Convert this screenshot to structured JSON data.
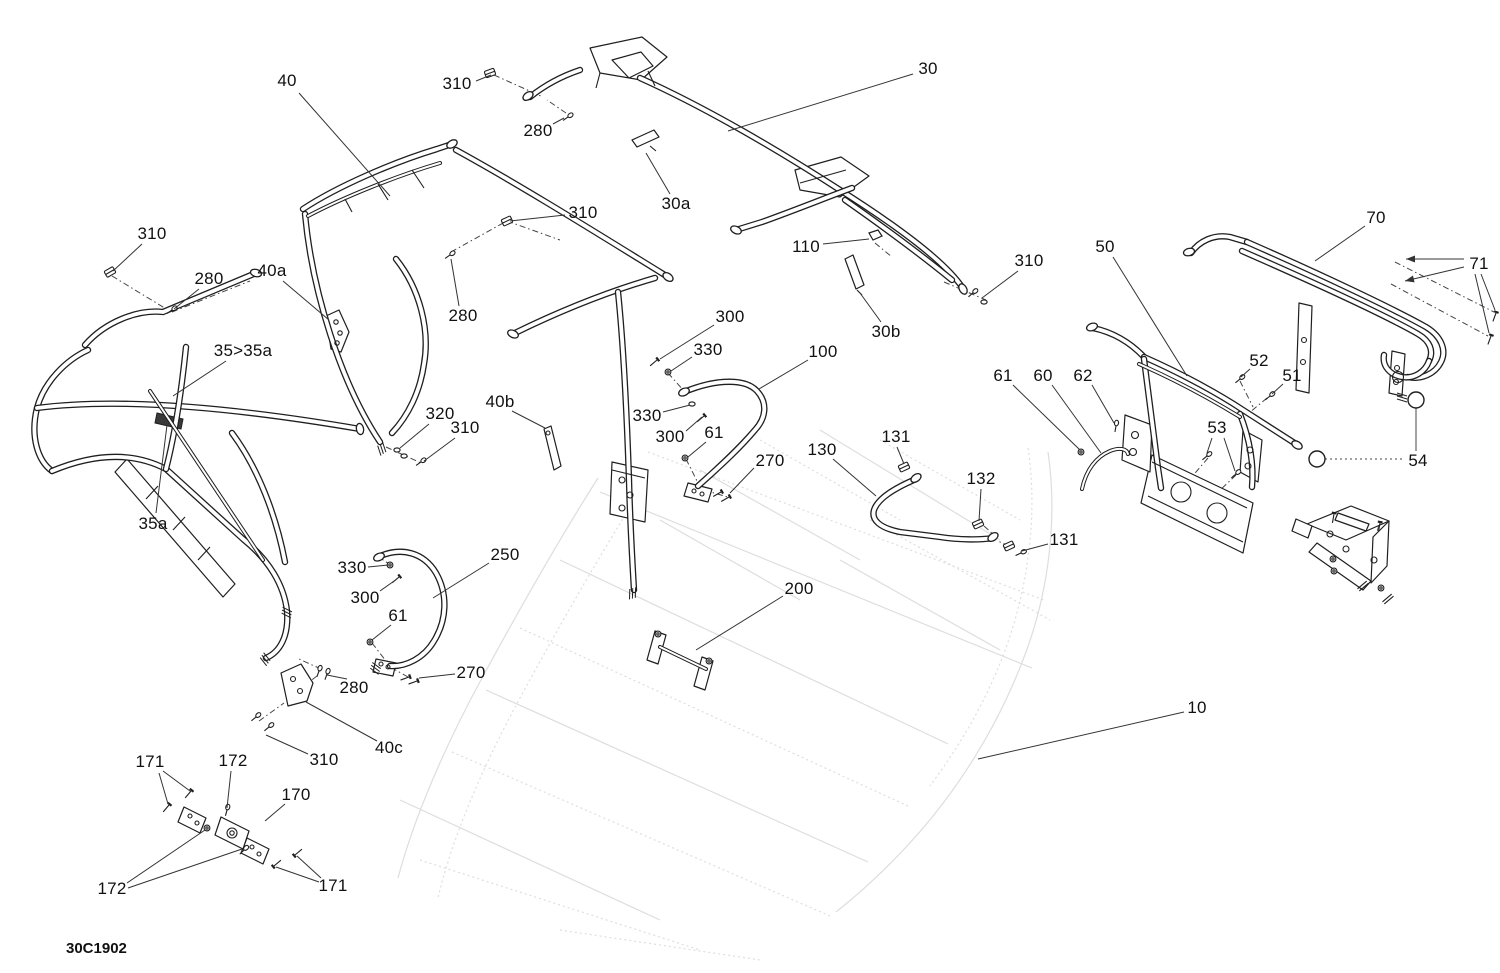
{
  "diagram": {
    "code": "30C1902",
    "colors": {
      "background": "#ffffff",
      "line": "#1f1f1f",
      "leader": "#333333",
      "ghost": "#c3c3c3",
      "dark_plate": "#3a3a3a"
    },
    "callouts": [
      {
        "label": "40",
        "x": 287,
        "y": 81,
        "leaders": [
          [
            299,
            93,
            390,
            196
          ]
        ]
      },
      {
        "label": "310",
        "x": 457,
        "y": 84,
        "leaders": [
          [
            476,
            81,
            491,
            75
          ]
        ]
      },
      {
        "label": "280",
        "x": 538,
        "y": 131,
        "leaders": [
          [
            553,
            124,
            564,
            118
          ]
        ]
      },
      {
        "label": "30",
        "x": 928,
        "y": 69,
        "leaders": [
          [
            913,
            74,
            728,
            131
          ]
        ]
      },
      {
        "label": "30a",
        "x": 676,
        "y": 204,
        "leaders": [
          [
            670,
            194,
            646,
            153
          ]
        ]
      },
      {
        "label": "310",
        "x": 583,
        "y": 213,
        "leaders": [
          [
            565,
            215,
            510,
            221
          ]
        ]
      },
      {
        "label": "110",
        "x": 806,
        "y": 247,
        "leaders": [
          [
            823,
            244,
            869,
            239
          ]
        ]
      },
      {
        "label": "310",
        "x": 1029,
        "y": 261,
        "leaders": [
          [
            1018,
            271,
            982,
            298
          ]
        ]
      },
      {
        "label": "30b",
        "x": 886,
        "y": 332,
        "leaders": [
          [
            881,
            322,
            860,
            293
          ]
        ]
      },
      {
        "label": "280",
        "x": 463,
        "y": 316,
        "leaders": [
          [
            459,
            306,
            451,
            259
          ]
        ]
      },
      {
        "label": "310",
        "x": 152,
        "y": 234,
        "leaders": [
          [
            142,
            244,
            113,
            271
          ]
        ]
      },
      {
        "label": "280",
        "x": 209,
        "y": 279,
        "leaders": [
          [
            199,
            289,
            174,
            309
          ]
        ]
      },
      {
        "label": "40a",
        "x": 272,
        "y": 271,
        "leaders": [
          [
            283,
            281,
            329,
            320
          ]
        ]
      },
      {
        "label": "35>35a",
        "x": 243,
        "y": 351,
        "leaders": [
          [
            226,
            361,
            173,
            396
          ]
        ]
      },
      {
        "label": "35a",
        "x": 153,
        "y": 524,
        "leaders": [
          [
            156,
            513,
            167,
            425
          ]
        ]
      },
      {
        "label": "50",
        "x": 1105,
        "y": 247,
        "leaders": [
          [
            1113,
            257,
            1187,
            376
          ]
        ]
      },
      {
        "label": "70",
        "x": 1376,
        "y": 218,
        "leaders": [
          [
            1365,
            226,
            1315,
            261
          ]
        ]
      },
      {
        "label": "71",
        "x": 1479,
        "y": 264,
        "leaders": [
          [
            1464,
            259,
            1406,
            259
          ],
          [
            1464,
            267,
            1405,
            281
          ],
          [
            1481,
            274,
            1495,
            310
          ],
          [
            1475,
            274,
            1489,
            333
          ]
        ],
        "arrow_ends": [
          0,
          1
        ]
      },
      {
        "label": "52",
        "x": 1259,
        "y": 361,
        "leaders": [
          [
            1250,
            369,
            1241,
            377
          ]
        ]
      },
      {
        "label": "51",
        "x": 1292,
        "y": 376,
        "leaders": [
          [
            1283,
            384,
            1272,
            394
          ]
        ]
      },
      {
        "label": "61",
        "x": 1003,
        "y": 376,
        "leaders": [
          [
            1013,
            385,
            1080,
            450
          ]
        ]
      },
      {
        "label": "60",
        "x": 1043,
        "y": 376,
        "leaders": [
          [
            1052,
            385,
            1101,
            453
          ]
        ]
      },
      {
        "label": "62",
        "x": 1083,
        "y": 376,
        "leaders": [
          [
            1092,
            385,
            1114,
            423
          ]
        ]
      },
      {
        "label": "53",
        "x": 1217,
        "y": 428,
        "leaders": [
          [
            1212,
            438,
            1207,
            453
          ],
          [
            1224,
            438,
            1235,
            471
          ]
        ]
      },
      {
        "label": "54",
        "x": 1418,
        "y": 461,
        "leaders": []
      },
      {
        "label": "100",
        "x": 823,
        "y": 352,
        "leaders": [
          [
            808,
            360,
            759,
            389
          ]
        ]
      },
      {
        "label": "300",
        "x": 730,
        "y": 317,
        "leaders": [
          [
            714,
            325,
            660,
            359
          ]
        ]
      },
      {
        "label": "330",
        "x": 708,
        "y": 350,
        "leaders": [
          [
            692,
            357,
            671,
            371
          ]
        ]
      },
      {
        "label": "330",
        "x": 647,
        "y": 416,
        "leaders": [
          [
            663,
            412,
            690,
            405
          ]
        ]
      },
      {
        "label": "300",
        "x": 670,
        "y": 437,
        "leaders": [
          [
            686,
            431,
            702,
            417
          ]
        ]
      },
      {
        "label": "61",
        "x": 714,
        "y": 433,
        "leaders": [
          [
            706,
            442,
            688,
            457
          ]
        ]
      },
      {
        "label": "270",
        "x": 770,
        "y": 461,
        "leaders": [
          [
            754,
            468,
            730,
            493
          ]
        ]
      },
      {
        "label": "130",
        "x": 822,
        "y": 450,
        "leaders": [
          [
            833,
            459,
            876,
            496
          ]
        ]
      },
      {
        "label": "131",
        "x": 896,
        "y": 437,
        "leaders": [
          [
            897,
            447,
            904,
            464
          ]
        ]
      },
      {
        "label": "132",
        "x": 981,
        "y": 479,
        "leaders": [
          [
            981,
            489,
            979,
            521
          ]
        ]
      },
      {
        "label": "131",
        "x": 1064,
        "y": 540,
        "leaders": [
          [
            1048,
            544,
            1022,
            551
          ]
        ]
      },
      {
        "label": "250",
        "x": 505,
        "y": 555,
        "leaders": [
          [
            489,
            563,
            433,
            598
          ]
        ]
      },
      {
        "label": "330",
        "x": 352,
        "y": 568,
        "leaders": [
          [
            368,
            567,
            388,
            565
          ]
        ]
      },
      {
        "label": "300",
        "x": 365,
        "y": 598,
        "leaders": [
          [
            380,
            591,
            397,
            579
          ]
        ]
      },
      {
        "label": "61",
        "x": 398,
        "y": 616,
        "leaders": [
          [
            391,
            625,
            372,
            640
          ]
        ]
      },
      {
        "label": "270",
        "x": 471,
        "y": 673,
        "leaders": [
          [
            455,
            674,
            419,
            678
          ]
        ]
      },
      {
        "label": "280",
        "x": 354,
        "y": 688,
        "leaders": [
          [
            347,
            679,
            327,
            675
          ]
        ]
      },
      {
        "label": "40c",
        "x": 389,
        "y": 748,
        "leaders": [
          [
            377,
            741,
            306,
            702
          ]
        ]
      },
      {
        "label": "310",
        "x": 324,
        "y": 760,
        "leaders": [
          [
            308,
            754,
            266,
            735
          ]
        ]
      },
      {
        "label": "171",
        "x": 150,
        "y": 762,
        "leaders": [
          [
            163,
            771,
            190,
            791
          ],
          [
            159,
            773,
            168,
            804
          ]
        ]
      },
      {
        "label": "172",
        "x": 233,
        "y": 761,
        "leaders": [
          [
            231,
            771,
            227,
            808
          ]
        ]
      },
      {
        "label": "170",
        "x": 296,
        "y": 795,
        "leaders": [
          [
            285,
            804,
            265,
            821
          ]
        ]
      },
      {
        "label": "172",
        "x": 112,
        "y": 889,
        "leaders": [
          [
            127,
            883,
            205,
            830
          ],
          [
            128,
            888,
            242,
            849
          ]
        ]
      },
      {
        "label": "171",
        "x": 333,
        "y": 886,
        "leaders": [
          [
            321,
            878,
            297,
            856
          ],
          [
            319,
            882,
            276,
            867
          ]
        ]
      },
      {
        "label": "200",
        "x": 799,
        "y": 589,
        "leaders": [
          [
            783,
            596,
            696,
            650
          ]
        ]
      },
      {
        "label": "10",
        "x": 1197,
        "y": 708,
        "leaders": [
          [
            1184,
            712,
            978,
            759
          ]
        ]
      },
      {
        "label": "320",
        "x": 440,
        "y": 414,
        "leaders": [
          [
            429,
            424,
            400,
            448
          ]
        ]
      },
      {
        "label": "310",
        "x": 465,
        "y": 428,
        "leaders": [
          [
            455,
            438,
            424,
            461
          ]
        ]
      },
      {
        "label": "40b",
        "x": 500,
        "y": 402,
        "leaders": [
          [
            512,
            411,
            545,
            428
          ]
        ]
      }
    ]
  }
}
